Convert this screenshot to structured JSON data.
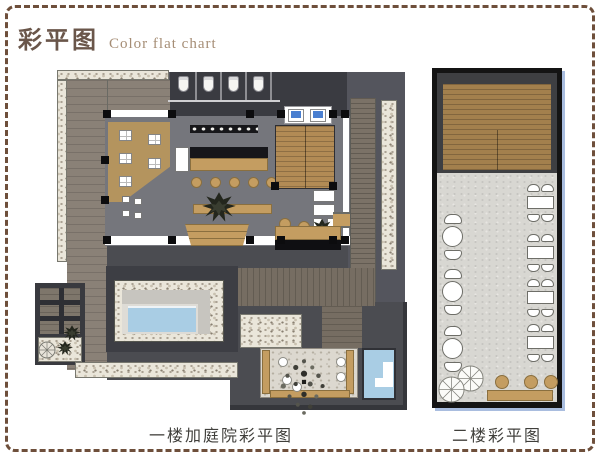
{
  "header": {
    "title_cn": "彩平图",
    "title_en": "Color flat chart"
  },
  "plans": {
    "first_floor": {
      "caption": "一楼加庭院彩平图"
    },
    "second_floor": {
      "caption": "二楼彩平图"
    }
  },
  "colors": {
    "border-brown": "#6e4f3b",
    "title-brown": "#6a564a",
    "subtitle-brown": "#a58d75",
    "caption-gray": "#403f3b",
    "site": "#54555d",
    "charcoal": "#3a3b41",
    "floor": "#75767c",
    "deck": "#8a8177",
    "tan": "#c49d61",
    "dining": "#b4945e",
    "pool": "#a9cde4",
    "concrete": "#d8d7d2",
    "roof": "#a3804d",
    "shadow-blue": "#a9bddf"
  }
}
